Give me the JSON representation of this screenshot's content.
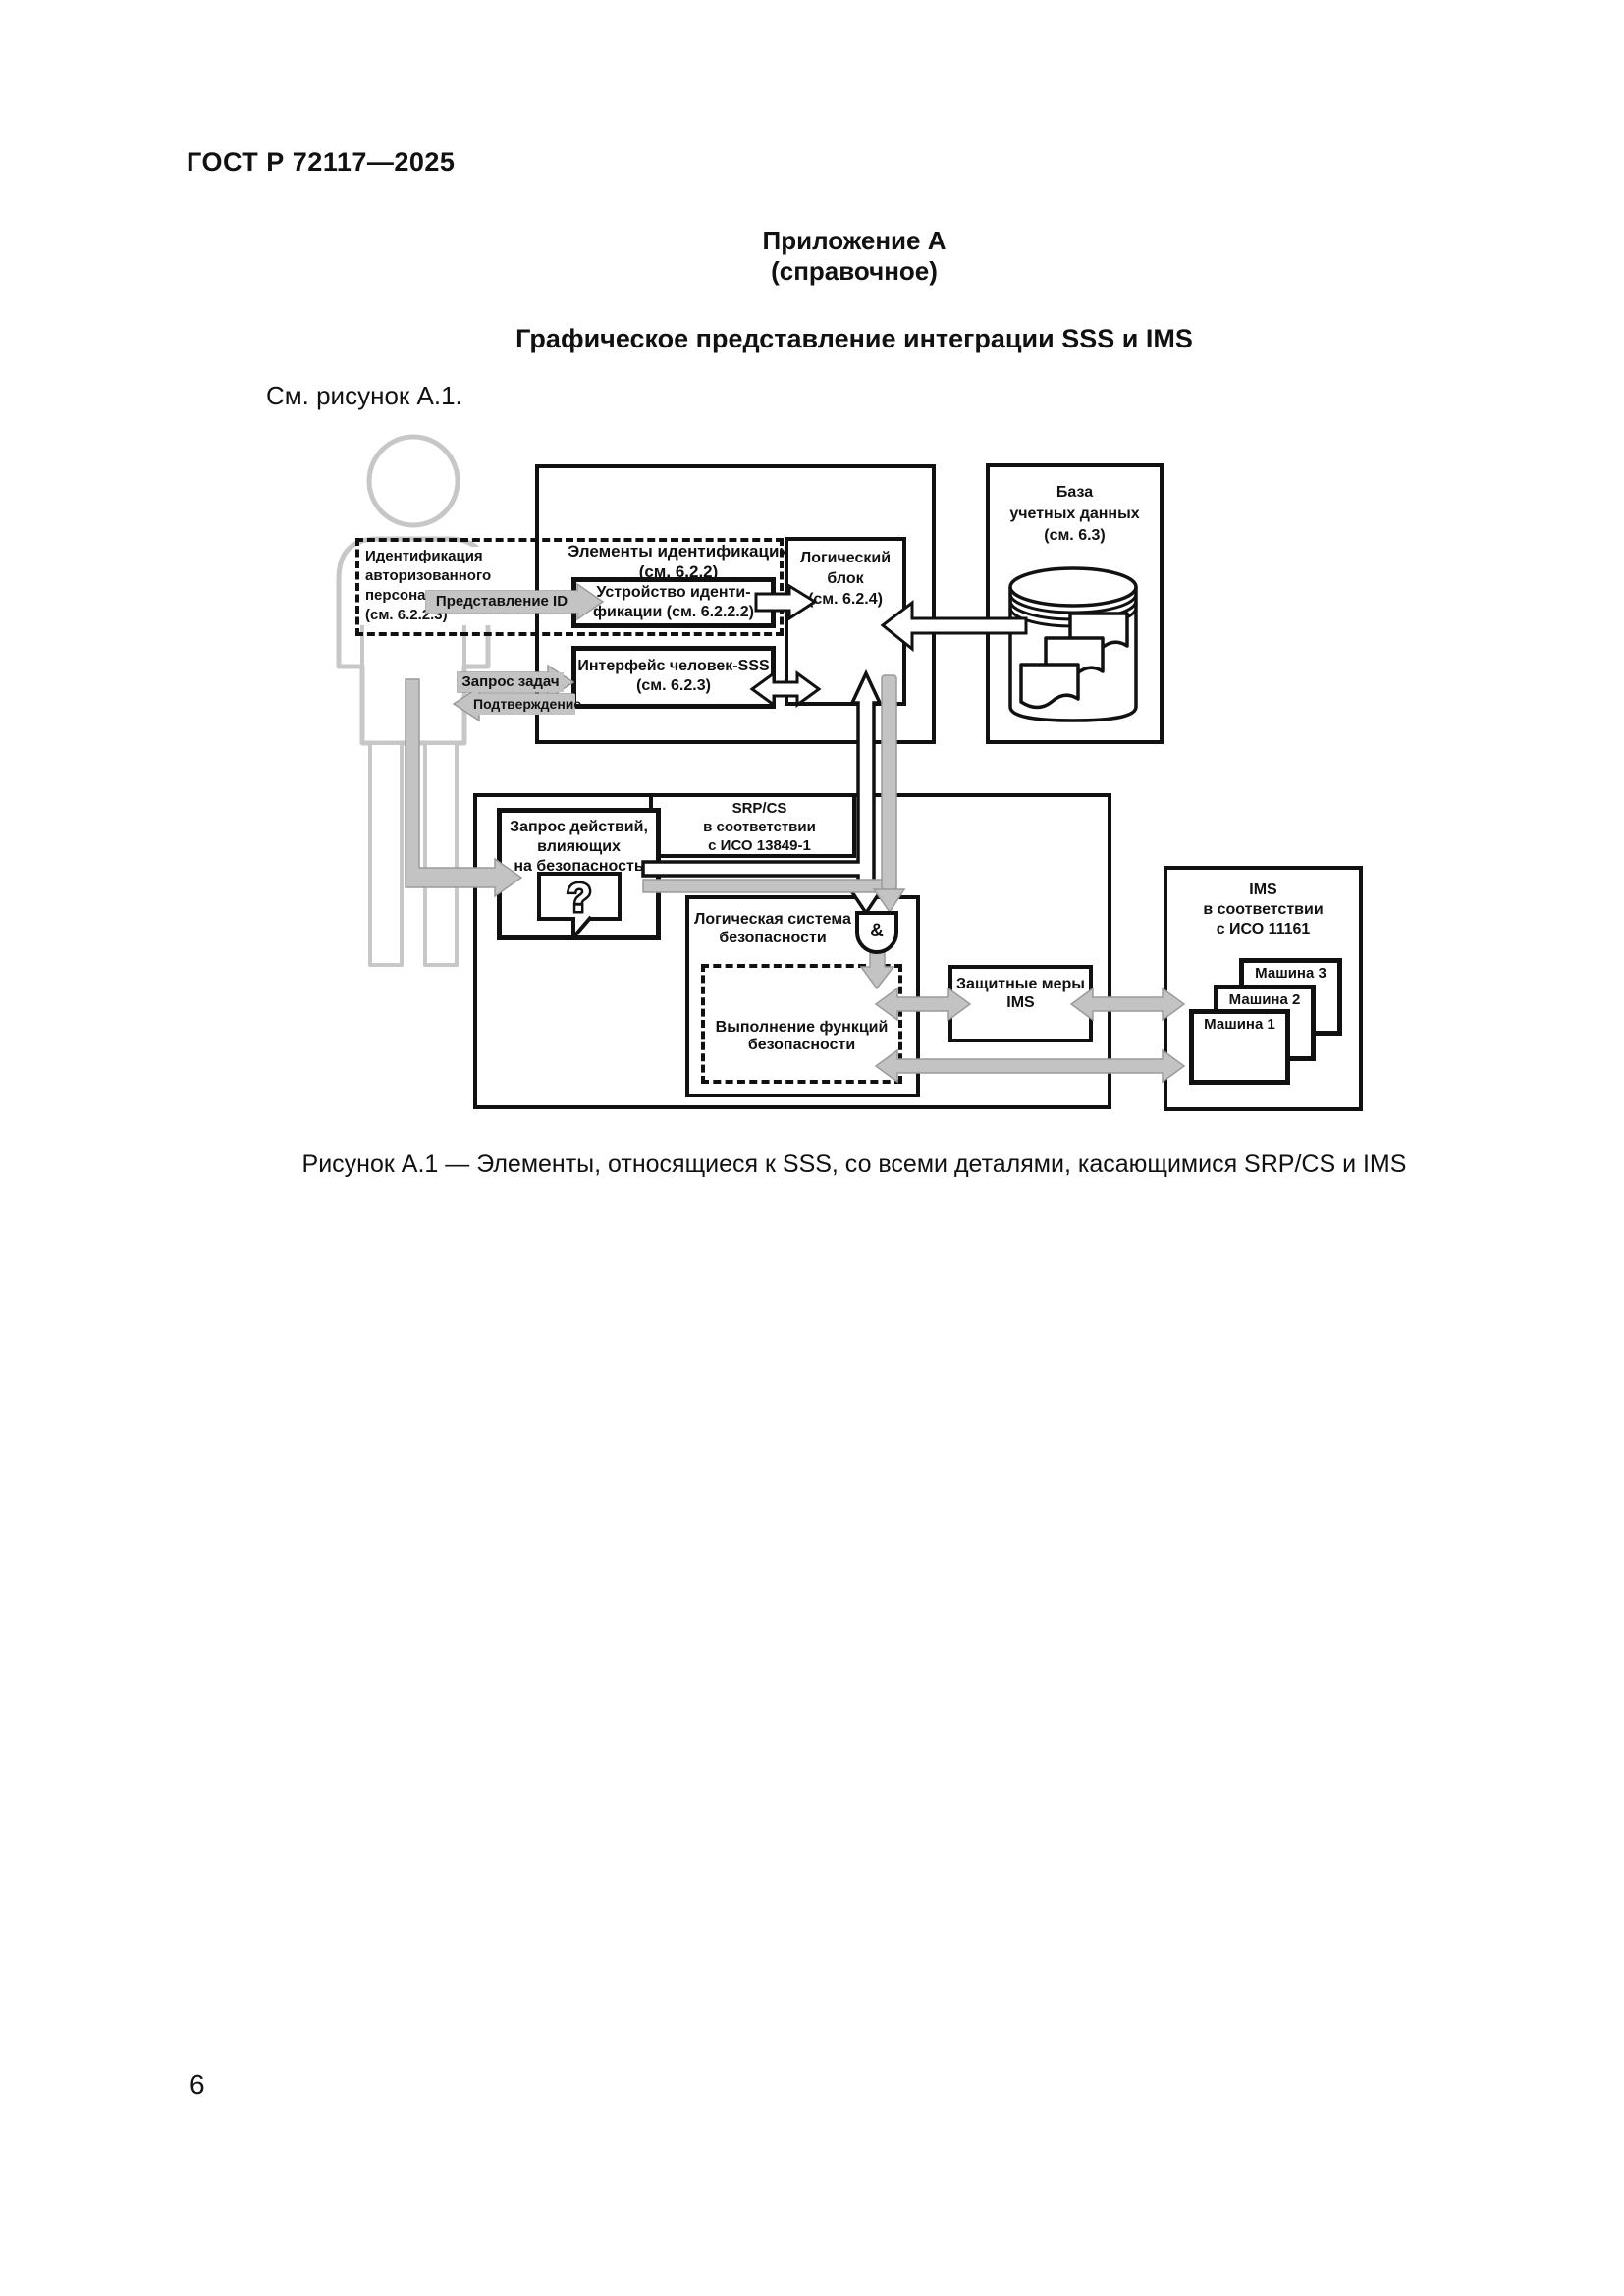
{
  "page": {
    "doc_number": "ГОСТ Р 72117—2025",
    "appendix_label": "Приложение А",
    "appendix_type": "(справочное)",
    "title": "Графическое представление интеграции SSS и IMS",
    "intro": "См. рисунок А.1.",
    "caption": "Рисунок А.1 — Элементы, относящиеся к SSS, со всеми деталями, касающимися SRP/CS и IMS",
    "page_number": "6"
  },
  "diagram": {
    "person_id_label": "Идентификация\nавторизованного\nперсонала\n(см. 6.2.2.3)",
    "id_elements_label": "Элементы идентификации\n(см. 6.2.2)",
    "id_device_label": "Устройство иденти-\nфикации (см. 6.2.2.2)",
    "human_sss_interface_label": "Интерфейс человек-SSS\n(см. 6.2.3)",
    "logic_unit_label": "Логический\nблок\n(см. 6.2.4)",
    "credentials_db_label": "База\nучетных данных\n(см. 6.3)",
    "presentation_id_label": "Представление ID",
    "task_request_label": "Запрос задач",
    "confirmation_label": "Подтверждение",
    "srpcs_label": "SRP/CS\nв соответствии\nс ИСО 13849-1",
    "safety_request_label": "Запрос действий,\nвлияющих\nна безопасность",
    "question_mark": "?",
    "safety_logic_label": "Логическая система\nбезопасности",
    "and_gate_label": "&",
    "safety_exec_label": "Выполнение функций\nбезопасности",
    "protective_measures_label": "Защитные меры\nIMS",
    "ims_label": "IMS\nв соответствии\nс ИСО 11161",
    "machine1_label": "Машина 1",
    "machine2_label": "Машина 2",
    "machine3_label": "Машина 3"
  },
  "colors": {
    "ink": "#111111",
    "arrow_gray": "#c3c3c3",
    "arrow_gray_outline": "#9b9b9b",
    "person_gray": "#c7c7c7",
    "paper": "#ffffff"
  }
}
